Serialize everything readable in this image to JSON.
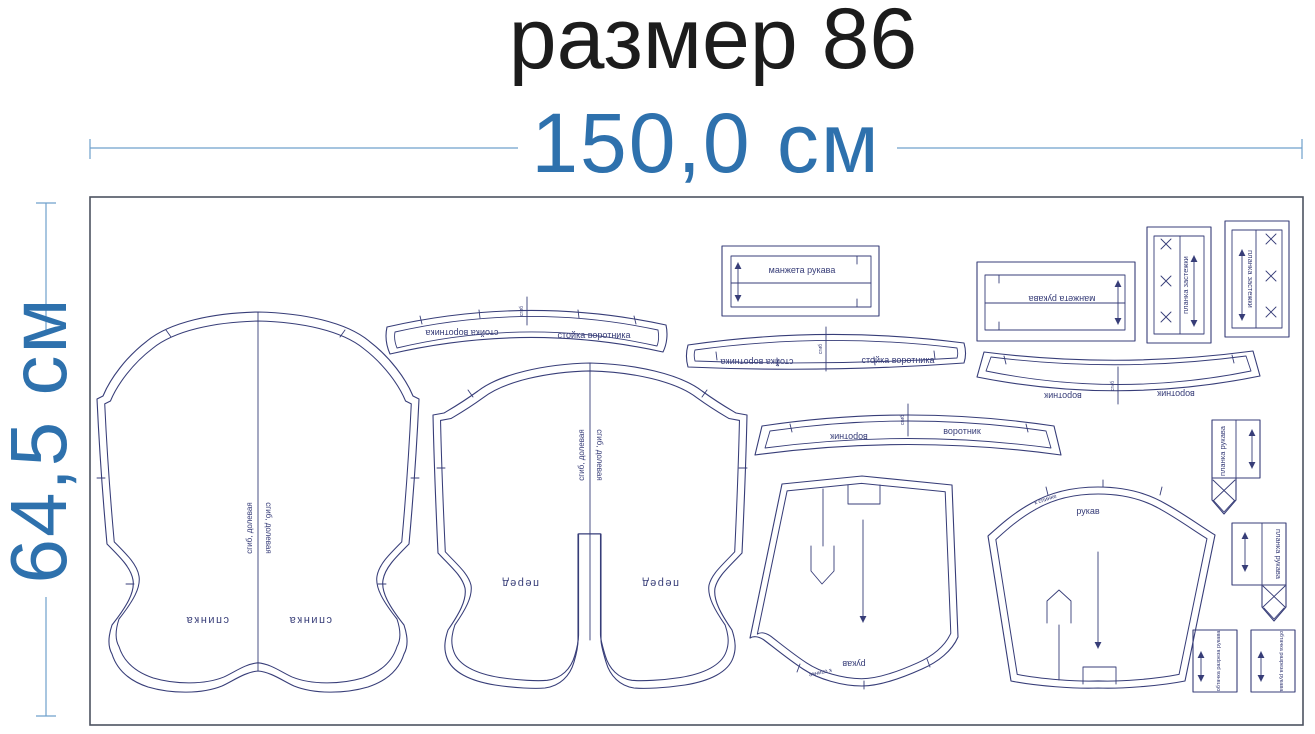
{
  "title": "размер 86",
  "dim_width": "150,0 см",
  "dim_height": "64,5 см",
  "labels": {
    "back": "спинка",
    "front": "перед",
    "collar_stand": "стойка воротника",
    "collar": "воротник",
    "cuff": "манжета рукава",
    "placket": "планка застежки",
    "sleeve": "рукав",
    "sleeve_edge_note": "к спинке",
    "sleeve_placket": "планка рукава",
    "slit_facing": "обтачка разреза рукава",
    "fold_grain": "сгиб, долевая",
    "fold": "сгиб"
  },
  "colors": {
    "title_text": "#1c1c1c",
    "dimension_accent": "#2e71ad",
    "pattern_outline": "#373d78",
    "fabric_border": "#4d5360",
    "background": "#ffffff"
  }
}
